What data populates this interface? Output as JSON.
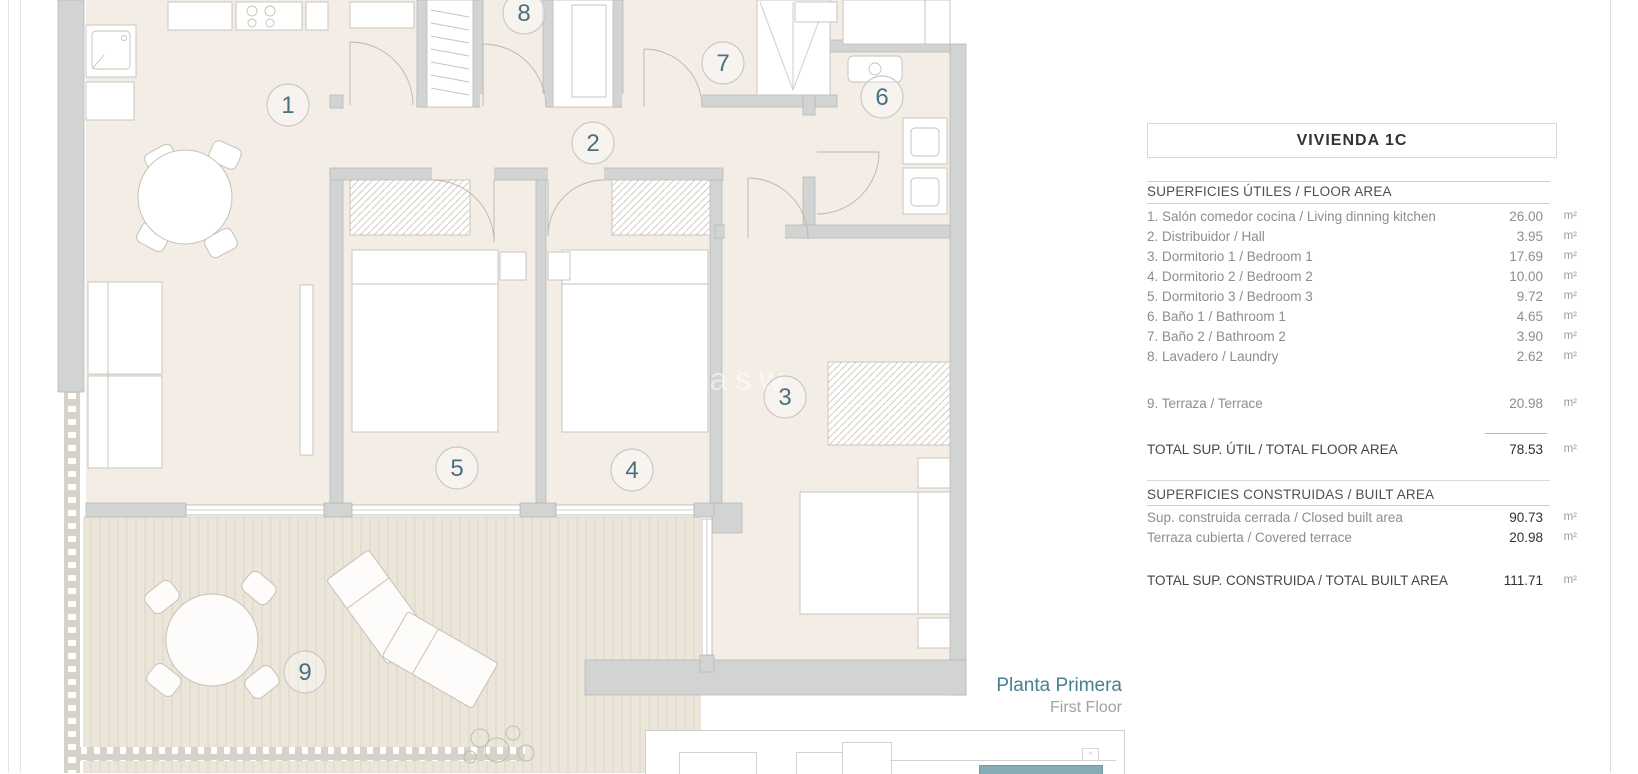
{
  "unit": {
    "title": "VIVIENDA 1C"
  },
  "areas": {
    "useful": {
      "section_title": "SUPERFICIES ÚTILES / FLOOR AREA",
      "rows": [
        {
          "label": "1. Salón comedor cocina / Living dinning kitchen",
          "value": "26.00",
          "unit": "m²"
        },
        {
          "label": "2. Distribuidor / Hall",
          "value": "3.95",
          "unit": "m²"
        },
        {
          "label": "3. Dormitorio 1 / Bedroom 1",
          "value": "17.69",
          "unit": "m²"
        },
        {
          "label": "4. Dormitorio 2 / Bedroom 2",
          "value": "10.00",
          "unit": "m²"
        },
        {
          "label": "5. Dormitorio 3 / Bedroom 3",
          "value": "9.72",
          "unit": "m²"
        },
        {
          "label": "6. Baño 1 / Bathroom 1",
          "value": "4.65",
          "unit": "m²"
        },
        {
          "label": "7. Baño 2 / Bathroom 2",
          "value": "3.90",
          "unit": "m²"
        },
        {
          "label": "8. Lavadero / Laundry",
          "value": "2.62",
          "unit": "m²"
        },
        {
          "label": "9. Terraza / Terrace",
          "value": "20.98",
          "unit": "m²"
        }
      ],
      "total": {
        "label": "TOTAL SUP. ÚTIL / TOTAL FLOOR AREA",
        "value": "78.53",
        "unit": "m²"
      }
    },
    "built": {
      "section_title": "SUPERFICIES CONSTRUIDAS / BUILT AREA",
      "rows": [
        {
          "label": "Sup. construida cerrada / Closed built area",
          "value": "90.73",
          "unit": "m²"
        },
        {
          "label": "Terraza cubierta / Covered terrace",
          "value": "20.98",
          "unit": "m²"
        }
      ],
      "total": {
        "label": "TOTAL SUP. CONSTRUIDA / TOTAL BUILT AREA",
        "value": "111.71",
        "unit": "m²"
      }
    }
  },
  "floor": {
    "name_es": "Planta Primera",
    "name_en": "First Floor"
  },
  "plan": {
    "watermark": "w.casasw",
    "markers": [
      {
        "label": "1"
      },
      {
        "label": "2"
      },
      {
        "label": "3"
      },
      {
        "label": "4"
      },
      {
        "label": "5"
      },
      {
        "label": "6"
      },
      {
        "label": "7"
      },
      {
        "label": "8"
      },
      {
        "label": "9"
      }
    ]
  },
  "colors": {
    "room_fill": "#f3ede6",
    "deck_fill": "#ece6da",
    "wall": "#d2d3d3",
    "marker_number": "#4b7080",
    "accent_teal": "#44808f",
    "keyplan_unit": "#85abb4"
  }
}
